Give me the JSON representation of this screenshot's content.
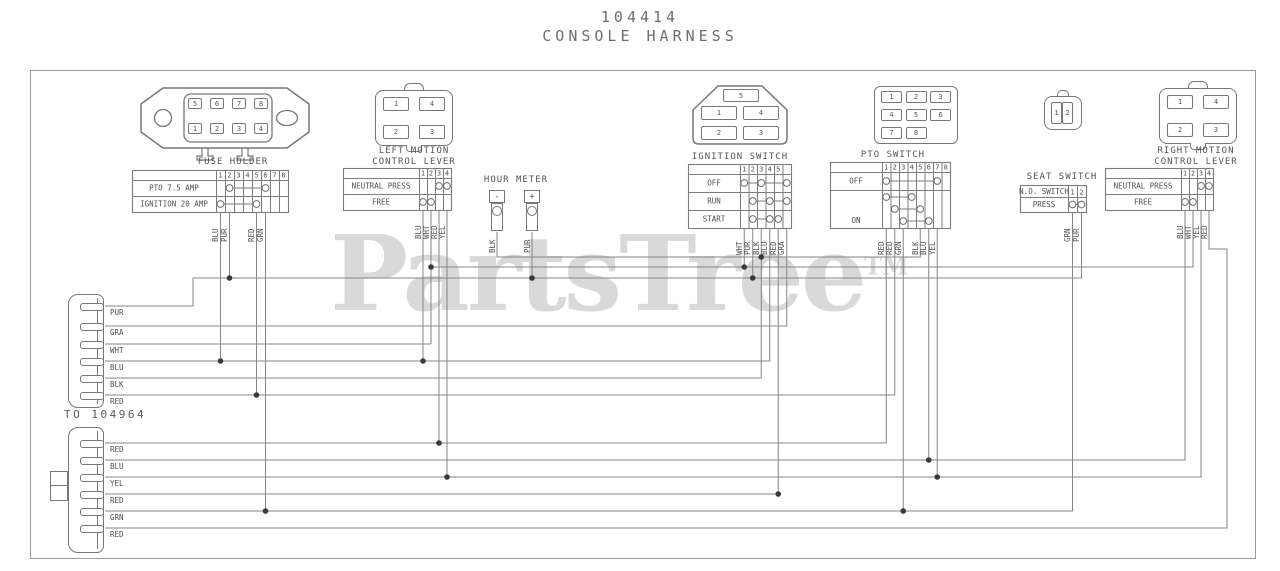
{
  "title": {
    "part_number": "104414",
    "name": "CONSOLE HARNESS"
  },
  "watermark": {
    "text": "PartsTree",
    "tm": "TM"
  },
  "to_note": "TO 104964",
  "colors": {
    "line": "#858585",
    "table_line": "#7d7d7d",
    "text": "#4f4f4f",
    "junction": "#3a3a3a",
    "watermark": "#d9d9d9",
    "border": "#9a9a9a"
  },
  "component_titles": [
    {
      "x": 233,
      "y": 157,
      "lines": [
        "FUSE HOLDER"
      ]
    },
    {
      "x": 414,
      "y": 146,
      "lines": [
        "LEFT MOTION",
        "CONTROL LEVER"
      ]
    },
    {
      "x": 516,
      "y": 175,
      "lines": [
        "HOUR METER"
      ]
    },
    {
      "x": 740,
      "y": 152,
      "lines": [
        "IGNITION SWITCH"
      ]
    },
    {
      "x": 893,
      "y": 150,
      "lines": [
        "PTO SWITCH"
      ]
    },
    {
      "x": 1062,
      "y": 172,
      "lines": [
        "SEAT SWITCH"
      ]
    },
    {
      "x": 1196,
      "y": 146,
      "lines": [
        "RIGHT MOTION",
        "CONTROL LEVER"
      ]
    }
  ],
  "pins": {
    "fuse": [
      [
        "5",
        "6",
        "7",
        "8"
      ],
      [
        "1",
        "2",
        "3",
        "4"
      ]
    ],
    "lever_left": [
      [
        "1",
        "4"
      ],
      [
        "2",
        "3"
      ]
    ],
    "ignition_top": "5",
    "ignition": [
      [
        "1",
        "4"
      ],
      [
        "2",
        "3"
      ]
    ],
    "pto": [
      [
        "1",
        "2",
        "3"
      ],
      [
        "4",
        "5",
        "6"
      ],
      [
        "7",
        "8"
      ]
    ],
    "seat": [
      "1",
      "2"
    ],
    "lever_right": [
      [
        "1",
        "4"
      ],
      [
        "2",
        "3"
      ]
    ]
  },
  "hour_meter": {
    "terminals": [
      {
        "sign": "-",
        "wire": "BLK"
      },
      {
        "sign": "+",
        "wire": "PUR"
      }
    ]
  },
  "tables": [
    {
      "name": "fuse-holder",
      "x": 132,
      "y": 170,
      "label_w": 84,
      "col_w": 9,
      "header_h": 10,
      "row_h": 16,
      "header_label": "",
      "cols": [
        "1",
        "2",
        "3",
        "4",
        "5",
        "6",
        "7",
        "8"
      ],
      "rows": [
        {
          "label": "PTO 7.5 AMP",
          "contacts": [
            2,
            6
          ]
        },
        {
          "label": "IGNITION 20 AMP",
          "contacts": [
            1,
            5
          ]
        }
      ]
    },
    {
      "name": "left-motion-lever",
      "x": 343,
      "y": 168,
      "label_w": 76,
      "col_w": 8,
      "header_h": 10,
      "row_h": 16,
      "header_label": "",
      "cols": [
        "1",
        "2",
        "3",
        "4"
      ],
      "rows": [
        {
          "label": "NEUTRAL PRESS",
          "contacts": [
            3,
            4
          ]
        },
        {
          "label": "FREE",
          "contacts": [
            1,
            2
          ]
        }
      ]
    },
    {
      "name": "ignition-switch",
      "x": 688,
      "y": 164,
      "label_w": 52,
      "col_w": 8.5,
      "header_h": 10,
      "row_h": 18,
      "header_label": "",
      "cols": [
        "1",
        "2",
        "3",
        "4",
        "5",
        ""
      ],
      "rows": [
        {
          "label": "OFF",
          "contacts": [
            1,
            3,
            6
          ]
        },
        {
          "label": "RUN",
          "contacts": [
            2,
            4,
            6
          ]
        },
        {
          "label": "START",
          "contacts": [
            2,
            4,
            5
          ]
        }
      ]
    },
    {
      "name": "pto-switch",
      "x": 830,
      "y": 162,
      "label_w": 52,
      "col_w": 8.5,
      "header_h": 10,
      "row_h": 18,
      "header_label": "",
      "cols": [
        "1",
        "2",
        "3",
        "4",
        "5",
        "6",
        "7",
        "8"
      ],
      "rows": [
        {
          "label": "OFF",
          "contacts": [
            1,
            7
          ]
        },
        {
          "label": "ON",
          "h": 38,
          "rungs": [
            [
              1,
              4
            ],
            [
              2,
              5
            ],
            [
              3,
              6
            ]
          ]
        }
      ]
    },
    {
      "name": "seat-switch",
      "x": 1020,
      "y": 185,
      "label_w": 48,
      "col_w": 9,
      "header_h": 12,
      "row_h": 15,
      "header_label": "N.O. SWITCH",
      "cols": [
        "1",
        "2"
      ],
      "rows": [
        {
          "label": "PRESS",
          "contacts": [
            1,
            2
          ]
        }
      ]
    },
    {
      "name": "right-motion-lever",
      "x": 1105,
      "y": 168,
      "label_w": 76,
      "col_w": 8,
      "header_h": 10,
      "row_h": 16,
      "header_label": "",
      "cols": [
        "1",
        "2",
        "3",
        "4"
      ],
      "rows": [
        {
          "label": "NEUTRAL PRESS",
          "contacts": [
            3,
            4
          ]
        },
        {
          "label": "FREE",
          "contacts": [
            1,
            2
          ]
        }
      ]
    }
  ],
  "stub_labels": [
    {
      "x": 220.5,
      "y": 242,
      "text": "BLU"
    },
    {
      "x": 229.5,
      "y": 242,
      "text": "PUR"
    },
    {
      "x": 256.5,
      "y": 242,
      "text": "RED"
    },
    {
      "x": 265.5,
      "y": 242,
      "text": "GRN"
    },
    {
      "x": 423,
      "y": 239,
      "text": "BLU"
    },
    {
      "x": 431,
      "y": 239,
      "text": "WHT"
    },
    {
      "x": 439,
      "y": 239,
      "text": "RED"
    },
    {
      "x": 447,
      "y": 239,
      "text": "YEL"
    },
    {
      "x": 497,
      "y": 253,
      "text": "BLK"
    },
    {
      "x": 532,
      "y": 253,
      "text": "PUR"
    },
    {
      "x": 744.25,
      "y": 255,
      "text": "WHT"
    },
    {
      "x": 752.75,
      "y": 255,
      "text": "PUR"
    },
    {
      "x": 761.25,
      "y": 255,
      "text": "BLK"
    },
    {
      "x": 769.75,
      "y": 255,
      "text": "BLU"
    },
    {
      "x": 778.25,
      "y": 255,
      "text": "RED"
    },
    {
      "x": 786.75,
      "y": 255,
      "text": "GRA"
    },
    {
      "x": 886.25,
      "y": 255,
      "text": "RED"
    },
    {
      "x": 894.75,
      "y": 255,
      "text": "RED"
    },
    {
      "x": 903.25,
      "y": 255,
      "text": "GRN"
    },
    {
      "x": 920.25,
      "y": 255,
      "text": "BLK"
    },
    {
      "x": 928.75,
      "y": 255,
      "text": "BLU"
    },
    {
      "x": 937.25,
      "y": 255,
      "text": "YEL"
    },
    {
      "x": 1072.5,
      "y": 242,
      "text": "GRN"
    },
    {
      "x": 1081.5,
      "y": 242,
      "text": "PUR"
    },
    {
      "x": 1185,
      "y": 239,
      "text": "BLU"
    },
    {
      "x": 1193,
      "y": 239,
      "text": "WHT"
    },
    {
      "x": 1201,
      "y": 239,
      "text": "YEL"
    },
    {
      "x": 1209,
      "y": 239,
      "text": "RED"
    }
  ],
  "blocks": {
    "upper": {
      "x": 68,
      "y": 294,
      "w": 36,
      "h": 114,
      "rows": [
        {
          "y": 306,
          "label": "PUR"
        },
        {
          "y": 326,
          "label": "GRA"
        },
        {
          "y": 344,
          "label": "WHT"
        },
        {
          "y": 361,
          "label": "BLU"
        },
        {
          "y": 378,
          "label": "BLK"
        },
        {
          "y": 395,
          "label": "RED"
        }
      ]
    },
    "lower": {
      "x": 68,
      "y": 427,
      "w": 36,
      "h": 126,
      "rows": [
        {
          "y": 443,
          "label": "RED"
        },
        {
          "y": 460,
          "label": "BLU"
        },
        {
          "y": 477,
          "label": "YEL"
        },
        {
          "y": 494,
          "label": "RED"
        },
        {
          "y": 511,
          "label": "GRN"
        },
        {
          "y": 528,
          "label": "RED"
        }
      ]
    }
  },
  "wires": [
    {
      "points": [
        [
          105,
          306
        ],
        [
          193,
          306
        ],
        [
          193,
          278
        ],
        [
          1081.5,
          278
        ],
        [
          1081.5,
          212
        ]
      ]
    },
    {
      "points": [
        [
          229.5,
          212
        ],
        [
          229.5,
          278
        ]
      ]
    },
    {
      "points": [
        [
          532,
          232
        ],
        [
          532,
          278
        ]
      ]
    },
    {
      "points": [
        [
          752.75,
          228
        ],
        [
          752.75,
          278
        ]
      ]
    },
    {
      "points": [
        [
          105,
          326
        ],
        [
          786.75,
          326
        ],
        [
          786.75,
          228
        ]
      ]
    },
    {
      "points": [
        [
          105,
          344
        ],
        [
          431,
          344
        ]
      ]
    },
    {
      "points": [
        [
          431,
          210
        ],
        [
          431,
          344
        ]
      ]
    },
    {
      "points": [
        [
          431,
          267
        ],
        [
          1193,
          267
        ],
        [
          1193,
          210
        ]
      ]
    },
    {
      "points": [
        [
          744.25,
          228
        ],
        [
          744.25,
          267
        ]
      ]
    },
    {
      "points": [
        [
          105,
          361
        ],
        [
          769.75,
          361
        ],
        [
          769.75,
          228
        ]
      ]
    },
    {
      "points": [
        [
          220.5,
          212
        ],
        [
          220.5,
          361
        ]
      ]
    },
    {
      "points": [
        [
          423,
          210
        ],
        [
          423,
          361
        ]
      ]
    },
    {
      "points": [
        [
          105,
          378
        ],
        [
          761.25,
          378
        ]
      ]
    },
    {
      "points": [
        [
          761.25,
          228
        ],
        [
          761.25,
          378
        ]
      ]
    },
    {
      "points": [
        [
          497,
          232
        ],
        [
          497,
          257
        ],
        [
          920.25,
          257
        ],
        [
          920.25,
          228
        ]
      ]
    },
    {
      "points": [
        [
          105,
          395
        ],
        [
          894.75,
          395
        ],
        [
          894.75,
          228
        ]
      ]
    },
    {
      "points": [
        [
          256.5,
          212
        ],
        [
          256.5,
          395
        ]
      ]
    },
    {
      "points": [
        [
          105,
          443
        ],
        [
          886.25,
          443
        ],
        [
          886.25,
          228
        ]
      ]
    },
    {
      "points": [
        [
          439,
          210
        ],
        [
          439,
          443
        ]
      ]
    },
    {
      "points": [
        [
          105,
          460
        ],
        [
          1185,
          460
        ],
        [
          1185,
          210
        ]
      ]
    },
    {
      "points": [
        [
          928.75,
          228
        ],
        [
          928.75,
          460
        ]
      ]
    },
    {
      "points": [
        [
          105,
          477
        ],
        [
          1201,
          477
        ],
        [
          1201,
          210
        ]
      ]
    },
    {
      "points": [
        [
          937.25,
          228
        ],
        [
          937.25,
          477
        ]
      ]
    },
    {
      "points": [
        [
          447,
          210
        ],
        [
          447,
          477
        ]
      ]
    },
    {
      "points": [
        [
          105,
          494
        ],
        [
          778.25,
          494
        ],
        [
          778.25,
          228
        ]
      ]
    },
    {
      "points": [
        [
          105,
          511
        ],
        [
          1072.5,
          511
        ],
        [
          1072.5,
          212
        ]
      ]
    },
    {
      "points": [
        [
          903.25,
          228
        ],
        [
          903.25,
          511
        ]
      ]
    },
    {
      "points": [
        [
          265.5,
          212
        ],
        [
          265.5,
          511
        ]
      ]
    },
    {
      "points": [
        [
          105,
          528
        ],
        [
          1227,
          528
        ],
        [
          1227,
          249
        ],
        [
          1209,
          249
        ],
        [
          1209,
          210
        ]
      ]
    }
  ],
  "junctions": [
    [
      229.5,
      278
    ],
    [
      532,
      278
    ],
    [
      752.75,
      278
    ],
    [
      431,
      267
    ],
    [
      744.25,
      267
    ],
    [
      761.25,
      257
    ],
    [
      220.5,
      361
    ],
    [
      423,
      361
    ],
    [
      256.5,
      395
    ],
    [
      439,
      443
    ],
    [
      928.75,
      460
    ],
    [
      447,
      477
    ],
    [
      937.25,
      477
    ],
    [
      778.25,
      494
    ],
    [
      265.5,
      511
    ],
    [
      903.25,
      511
    ]
  ]
}
